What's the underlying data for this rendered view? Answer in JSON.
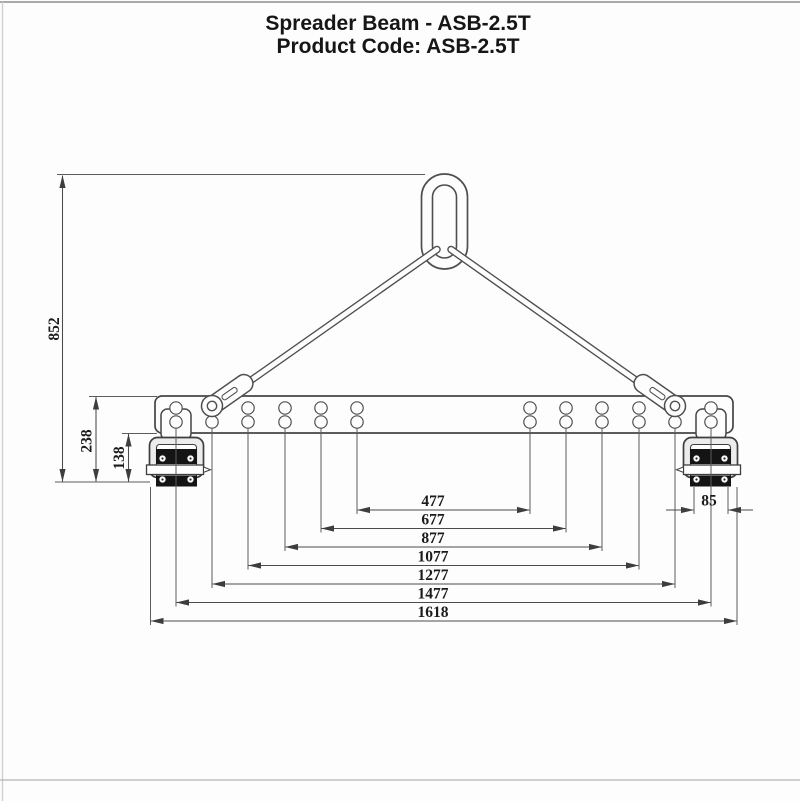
{
  "header": {
    "title": "Spreader Beam - ASB-2.5T",
    "product_code": "Product Code: ASB-2.5T"
  },
  "drawing": {
    "dimensions_mm": {
      "overall_height": "852",
      "beam_top_to_clamp_bottom": "238",
      "beam_bottom_to_clamp_bottom": "138",
      "clamp_jaw_width": "85",
      "hole_spreads": [
        "477",
        "677",
        "877",
        "1077",
        "1277",
        "1477"
      ],
      "overall_length": "1618"
    },
    "colors": {
      "line": "#4a4a4a",
      "dark_fill": "#141414",
      "frame_fill": "#ececec"
    }
  }
}
